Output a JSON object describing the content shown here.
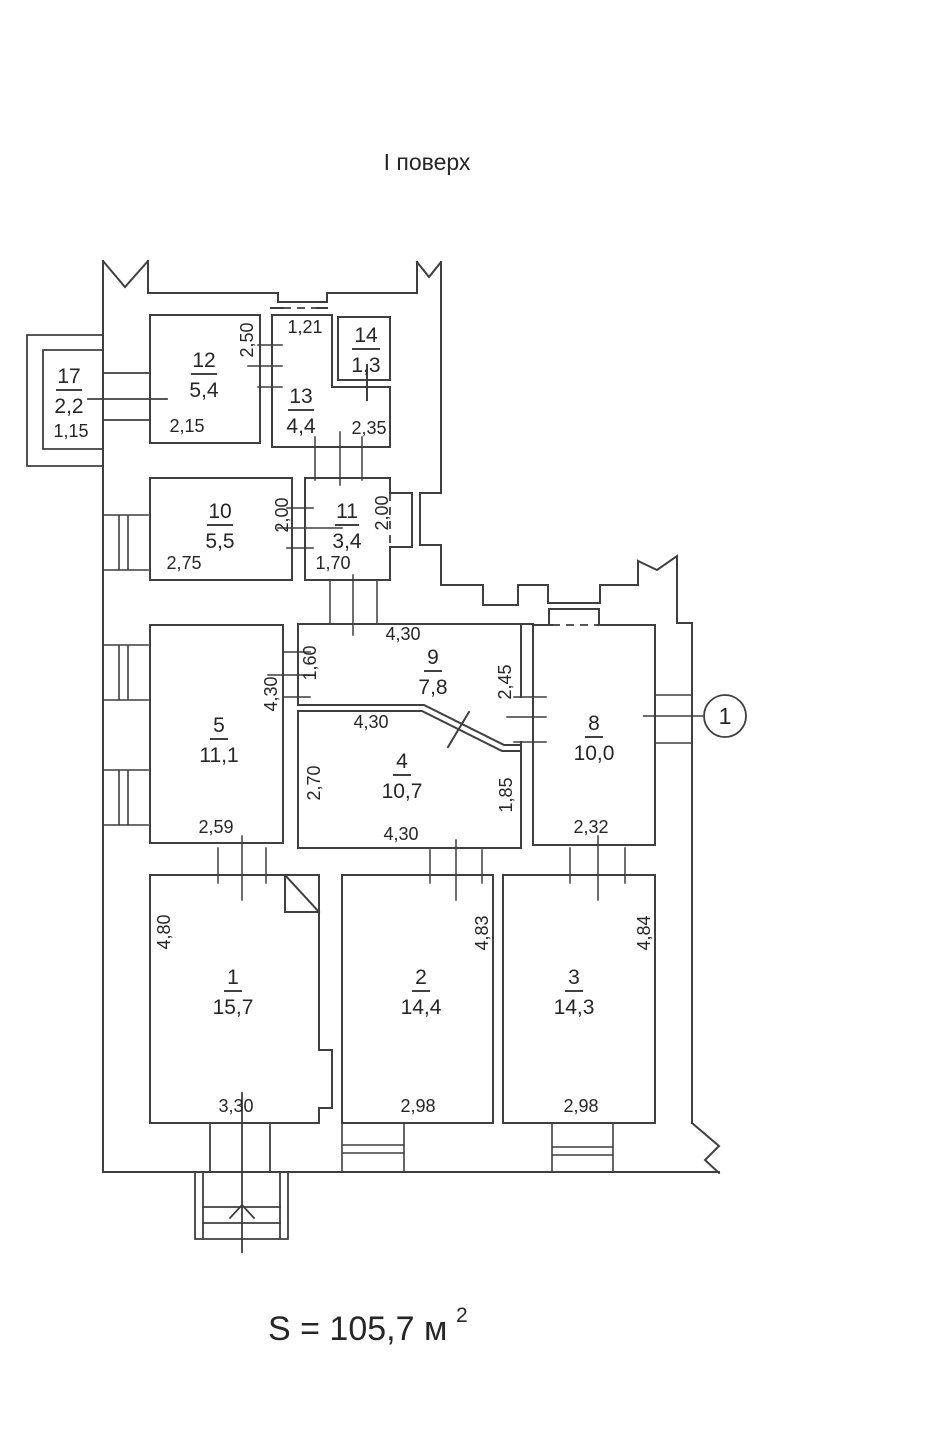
{
  "title": "І поверх",
  "total_area": {
    "prefix": "S = 105,7 м",
    "exponent": "2"
  },
  "entry": {
    "marker": "1"
  },
  "rooms": {
    "r1": {
      "number": "1",
      "area": "15,7"
    },
    "r2": {
      "number": "2",
      "area": "14,4"
    },
    "r3": {
      "number": "3",
      "area": "14,3"
    },
    "r4": {
      "number": "4",
      "area": "10,7"
    },
    "r5": {
      "number": "5",
      "area": "11,1"
    },
    "r8": {
      "number": "8",
      "area": "10,0"
    },
    "r9": {
      "number": "9",
      "area": "7,8"
    },
    "r10": {
      "number": "10",
      "area": "5,5"
    },
    "r11": {
      "number": "11",
      "area": "3,4"
    },
    "r12": {
      "number": "12",
      "area": "5,4"
    },
    "r13": {
      "number": "13",
      "area": "4,4"
    },
    "r14": {
      "number": "14",
      "area": "1,3"
    },
    "r17": {
      "number": "17",
      "area": "2,2"
    }
  },
  "dims": {
    "room17_width": "1,15",
    "room12_width": "2,15",
    "room12_depth": "2,50",
    "room13_entry": "1,21",
    "room13_width": "2,35",
    "room10_width": "2,75",
    "room10_depth": "2,00",
    "room11_width": "1,70",
    "room11_depth": "2,00",
    "room5_width": "2,59",
    "room5_depth": "4,30",
    "room9_width": "4,30",
    "room9_left": "1,60",
    "room9_right": "2,45",
    "room4_top": "4,30",
    "room4_bottom": "4,30",
    "room4_left": "2,70",
    "room4_right": "1,85",
    "room8_width": "2,32",
    "room1_depth": "4,80",
    "room1_width": "3,30",
    "room2_depth": "4,83",
    "room2_width": "2,98",
    "room3_depth": "4,84",
    "room3_width": "2,98"
  },
  "colors": {
    "line": "#3f3f3f",
    "text": "#262626"
  }
}
